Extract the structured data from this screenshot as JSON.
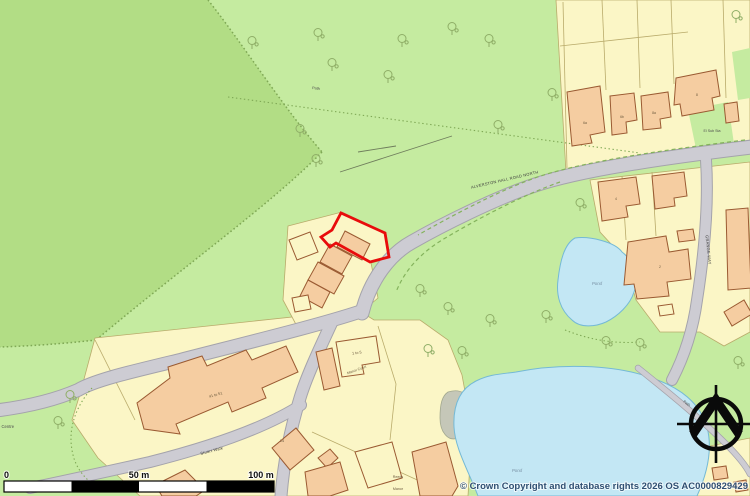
{
  "palette": {
    "green_light": "#c5eba0",
    "green_wood": "#b2dd85",
    "green_dash": "#84b35c",
    "wood_dot": "#7fa855",
    "road_fill": "#cdccd3",
    "road_case": "#a4a3ab",
    "parcel": "#fbf6c6",
    "parcel_line": "#b9ab6b",
    "building": "#f5cda1",
    "building_line": "#9a5a32",
    "water": "#c3e7f4",
    "water_edge": "#74b9d6",
    "water_label": "#7b93a6",
    "tree": "#8fae67",
    "plot_red": "#e80c0c",
    "copyright": "#2f4f72"
  },
  "labels": {
    "road_main": "ALVERSTON HALL ROAD NORTH",
    "road_side": "GRANGE WAY",
    "road_stuart": "Stuart Walk",
    "path_top": "Path",
    "path_bottom": "Path",
    "pond_small": "Pond",
    "pond_large": "Pond",
    "welfare": "Welfare Centre",
    "el_sub_sta": "El Sub Sta",
    "flats_1to5": "1 to 5",
    "court": "Manor Court",
    "flats_41to51": "41 to 51",
    "no_14": "14",
    "reeds": "Reeds",
    "manor": "Manor",
    "h6a": "6a",
    "h6b": "6b",
    "h8a": "8a",
    "h8": "8",
    "h4": "4",
    "h2": "2"
  },
  "scalebar": {
    "zero": "0",
    "mid": "50 m",
    "full": "100 m"
  },
  "copyright": "© Crown Copyright and database rights 2026 OS AC0000829429"
}
